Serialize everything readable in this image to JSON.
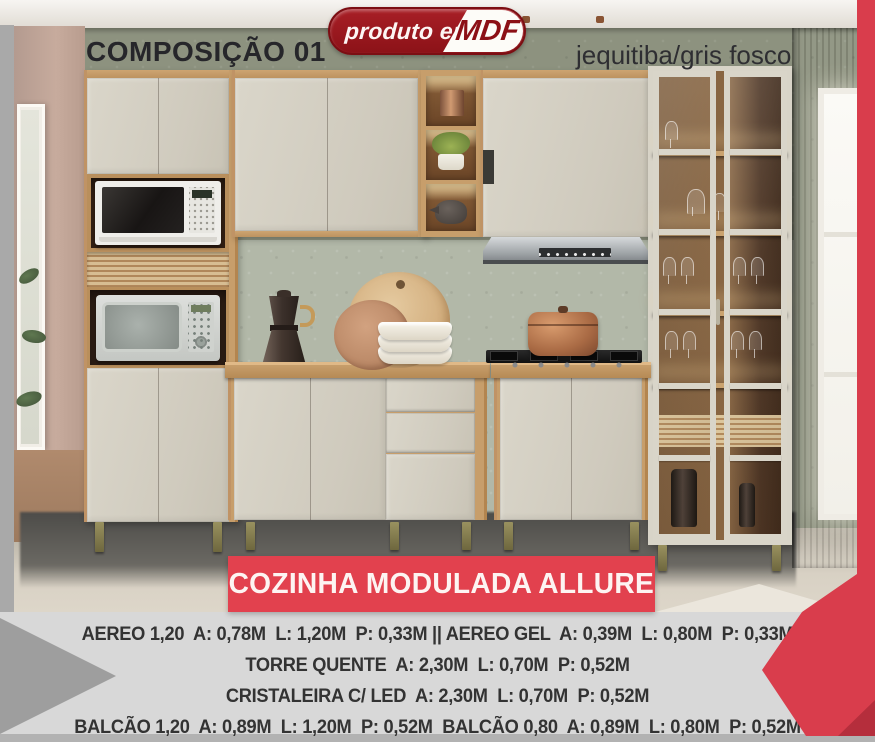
{
  "header": {
    "composition_label": "COMPOSIÇÃO 01",
    "badge": {
      "prefix": "produto em",
      "material": "MDF"
    },
    "finish_label": "jequitiba/gris fosco"
  },
  "banner": {
    "title": "COZINHA MODULADA ALLURE"
  },
  "specs": {
    "lines": [
      "AEREO 1,20  A: 0,78M  L: 1,20M  P: 0,33M || AEREO GEL  A: 0,39M  L: 0,80M  P: 0,33M",
      "TORRE QUENTE  A: 2,30M  L: 0,70M  P: 0,52M",
      "CRISTALEIRA C/ LED  A: 2,30M  L: 0,70M  P: 0,52M",
      "BALCÃO 1,20  A: 0,89M  L: 1,20M  P: 0,52M  BALCÃO 0,80  A: 0,89M  L: 0,80M  P: 0,52M"
    ]
  },
  "colors": {
    "accent_red": "#e2414e",
    "badge_red": "#8c1218",
    "cabinet_gris_fosco": "#d5d1c5",
    "wood_jequitiba": "#c79e6b",
    "band_gray": "#d8d8d8"
  }
}
